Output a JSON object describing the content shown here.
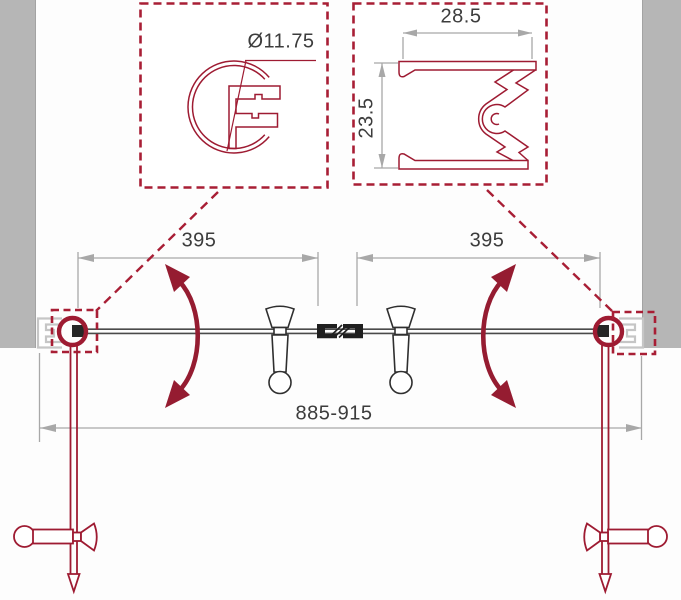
{
  "drawing": {
    "type": "technical-diagram",
    "subject": "double swing door plan view with profile detail callouts",
    "colors": {
      "accent_red": "#9E1B32",
      "dashed_red": "#A81E35",
      "drawing_dark": "#4A4A4A",
      "handle_dark": "#2F2F2F",
      "dimension_gray": "#A8A8A8",
      "wall_gray": "#B6B6B6",
      "profile_light_gray": "#C6C6C6",
      "background": "#FDFDFD"
    },
    "detail_callouts": {
      "round_post_profile": {
        "diameter_label": "Ø11.75"
      },
      "wall_profile": {
        "width_label": "28.5",
        "height_label": "23.5"
      }
    },
    "plan_view": {
      "left_door_width_label": "395",
      "right_door_width_label": "395",
      "overall_width_label": "885-915"
    }
  }
}
